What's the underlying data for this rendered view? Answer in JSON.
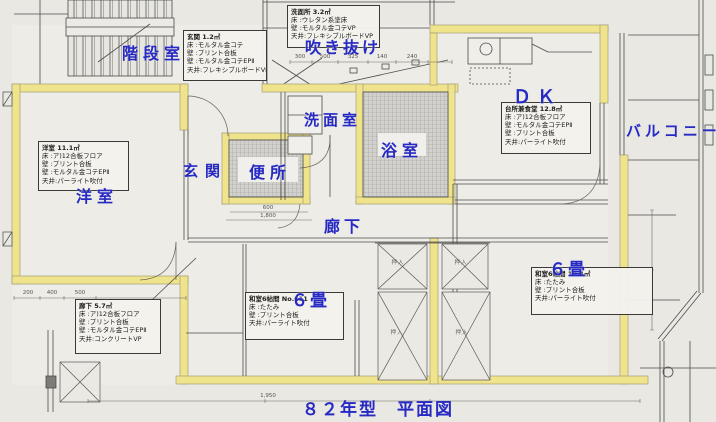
{
  "title": "８２年型　平面図",
  "colors": {
    "label_blue": "#2629c4",
    "wall_yellow": "#efe38c",
    "paper": "#e9e8e3"
  },
  "labels": {
    "stairwell": "階段室",
    "void": "吹き抜け",
    "washroom": "洗面室",
    "bathroom": "浴室",
    "entrance": "玄関",
    "toilet": "便所",
    "western_room": "洋室",
    "corridor": "廊下",
    "dining_kitchen": "ＤＫ",
    "balcony": "バルコニー",
    "six_mat_center": "６畳",
    "six_mat_right": "６畳"
  },
  "closet_label": "押入",
  "spec_boxes": [
    {
      "id": "genkan",
      "title": "玄関 1.2㎡",
      "lines": [
        "床 :モルタル金コテ",
        "壁 :プリント合板",
        "壁 :モルタル金コテEPⅡ",
        "天井:フレキシブルボードVP"
      ]
    },
    {
      "id": "senmenjo",
      "title": "洗面所 3.2㎡",
      "lines": [
        "床 :ウレタン系塗床",
        "壁 :モルタル金コテVP",
        "天井:フレキシブルボードVP"
      ]
    },
    {
      "id": "yoshitsu",
      "title": "洋室 11.1㎡",
      "lines": [
        "床 :ア)12合板フロア",
        "壁 :プリント合板",
        "壁 :モルタル金コテEPⅡ",
        "天井:パーライト吹付"
      ]
    },
    {
      "id": "dk",
      "title": "台所兼食堂 12.8㎡",
      "lines": [
        "床 :ア)12合板フロア",
        "壁 :モルタル金コテEPⅡ",
        "壁 :プリント合板",
        "天井:パーライト吹付"
      ]
    },
    {
      "id": "roka",
      "title": "廊下 5.7㎡",
      "lines": [
        "床 :ア)12合板フロア",
        "壁 :プリント合板",
        "壁 :モルタル金コテEPⅡ",
        "天井:コンクリートVP"
      ]
    },
    {
      "id": "washitsu_center",
      "title": "和室6帖間 No.611",
      "lines": [
        "床 :たたみ",
        "壁 :プリント合板",
        "天井:パーライト吹付"
      ]
    },
    {
      "id": "washitsu_right",
      "title": "和室6帖間 10.4㎡",
      "lines": [
        "床 :たたみ",
        "壁 :プリント合板",
        "天井:パーライト吹付"
      ]
    }
  ],
  "dims": [
    "300",
    "500",
    "325",
    "140",
    "240",
    "600",
    "1,800",
    "200",
    "400",
    "500",
    "1,950"
  ]
}
